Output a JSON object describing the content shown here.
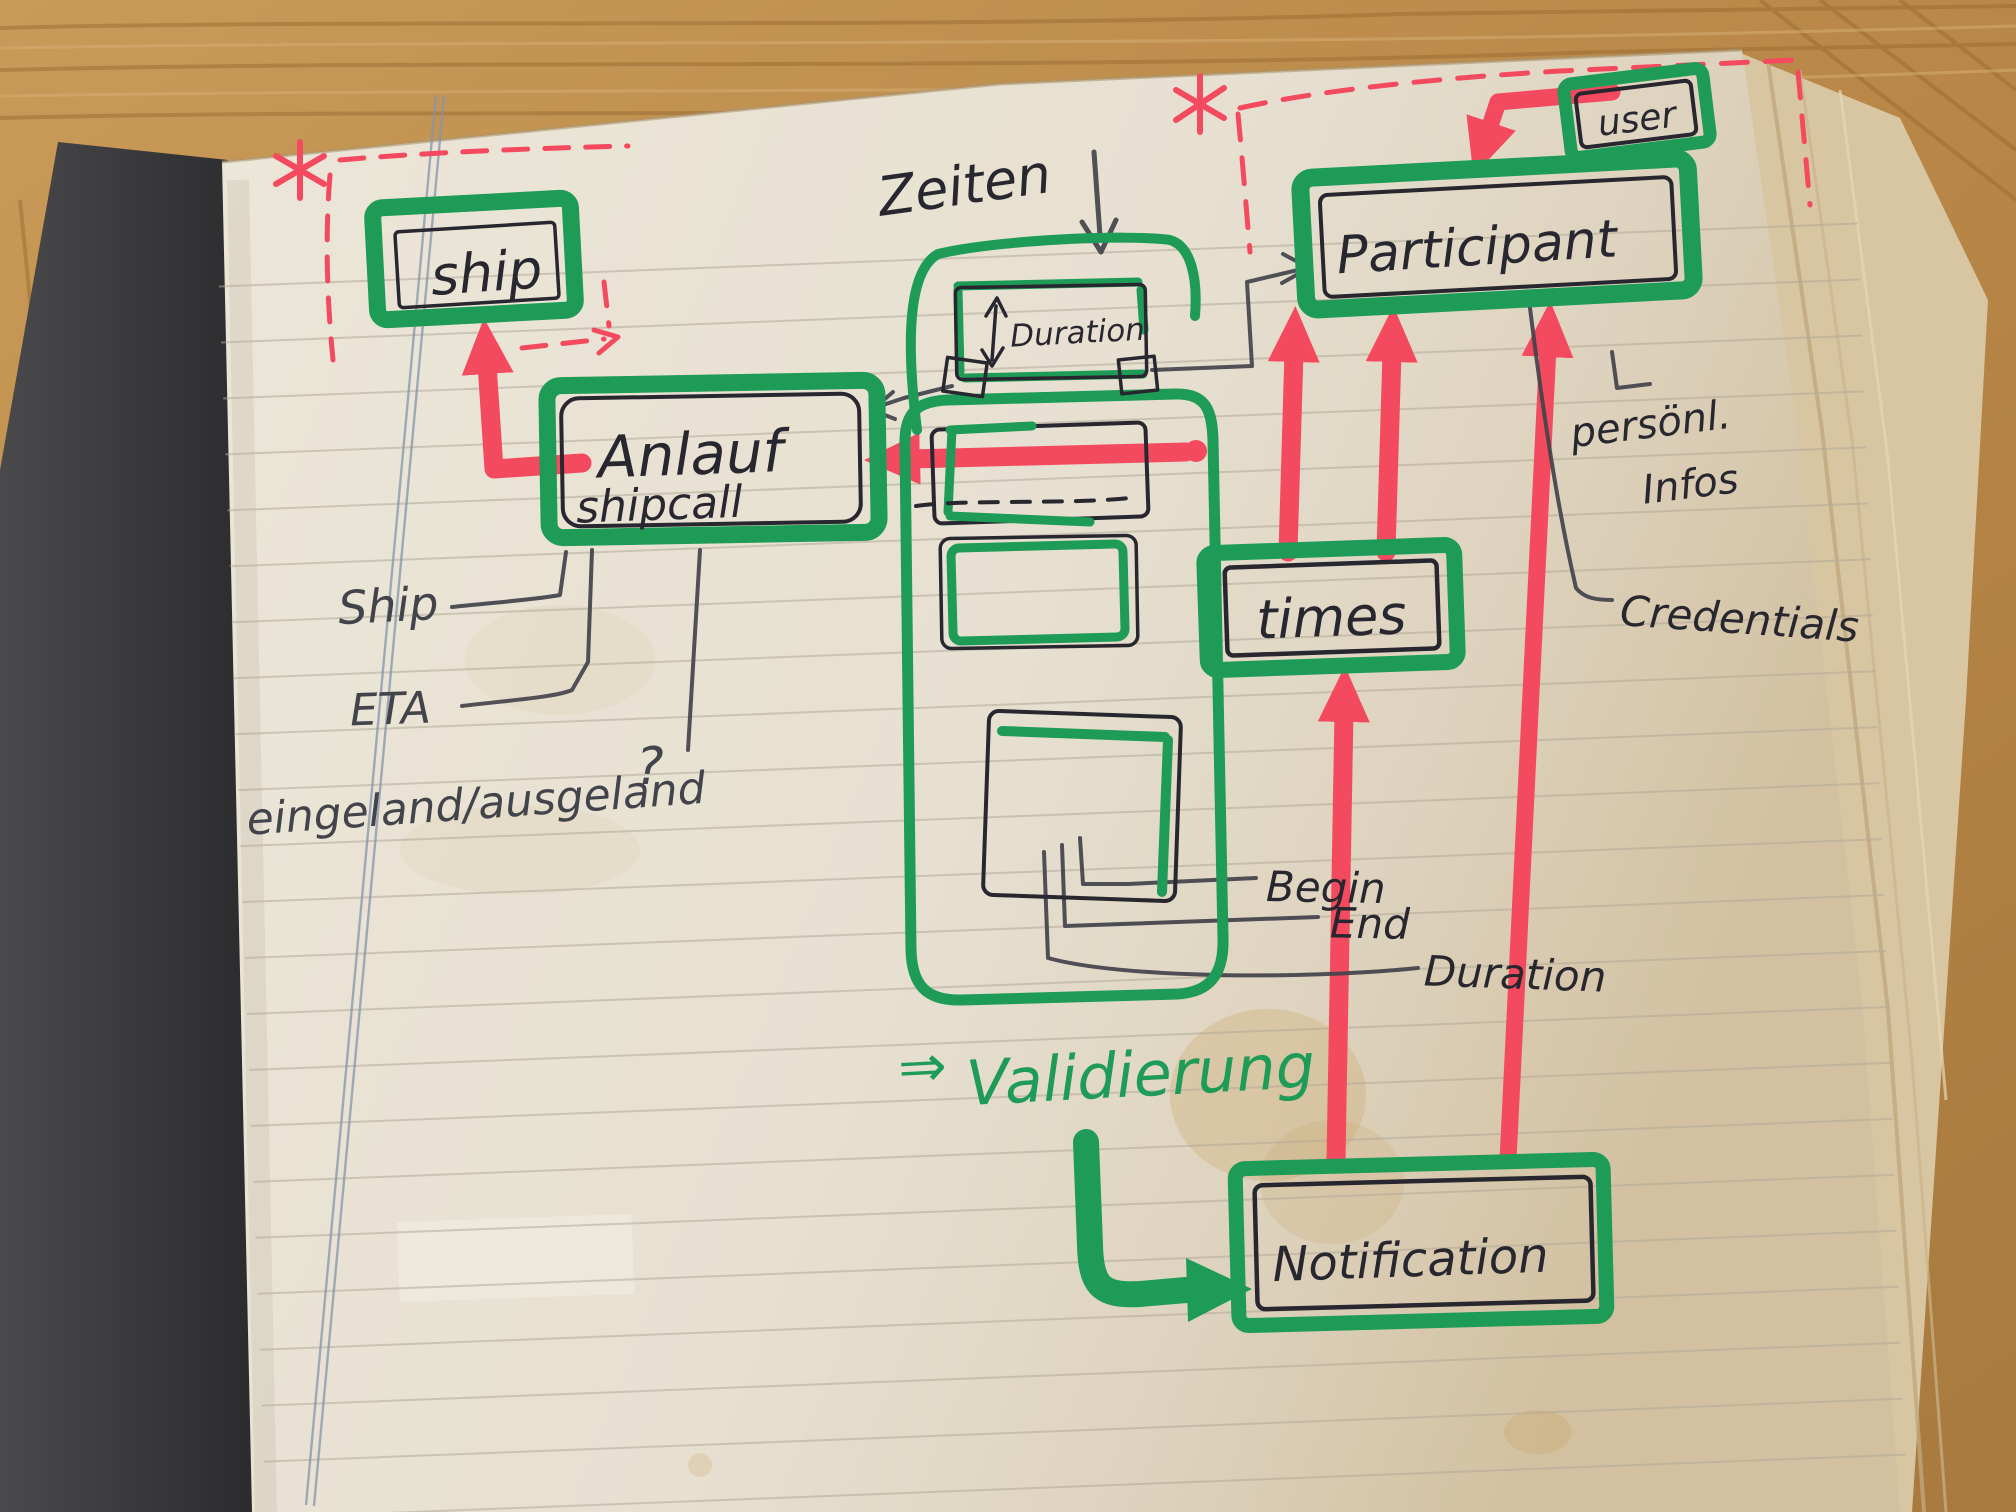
{
  "diagram": {
    "entities": {
      "ship": "ship",
      "anlauf": "Anlauf",
      "anlauf_sub": "shipcall",
      "participant": "Participant",
      "user": "user",
      "times": "times",
      "notification": "Notification",
      "duration_box": "Duration"
    },
    "labels": {
      "zeiten": "Zeiten",
      "zeiten_arrow": "↓",
      "ship_attr": "Ship",
      "eta": "ETA",
      "eingeland": "eingeland/ausgeland",
      "question": "?",
      "begin": "Begin",
      "end": "End",
      "duration": "Duration",
      "personal": "persönl.",
      "infos": "Infos",
      "credentials": "Credentials",
      "validierung_arrow": "⇒",
      "validierung": "Validierung",
      "asterisk": "*"
    },
    "colors": {
      "marker_green": "#1e9b57",
      "marker_red": "#f44a5f",
      "ink": "#28272f",
      "pencil": "#43434c",
      "paper": "#e9e2d4",
      "paper_edge": "#d8c5a2",
      "wood": "#b98747",
      "cover": "#3a393c"
    }
  }
}
